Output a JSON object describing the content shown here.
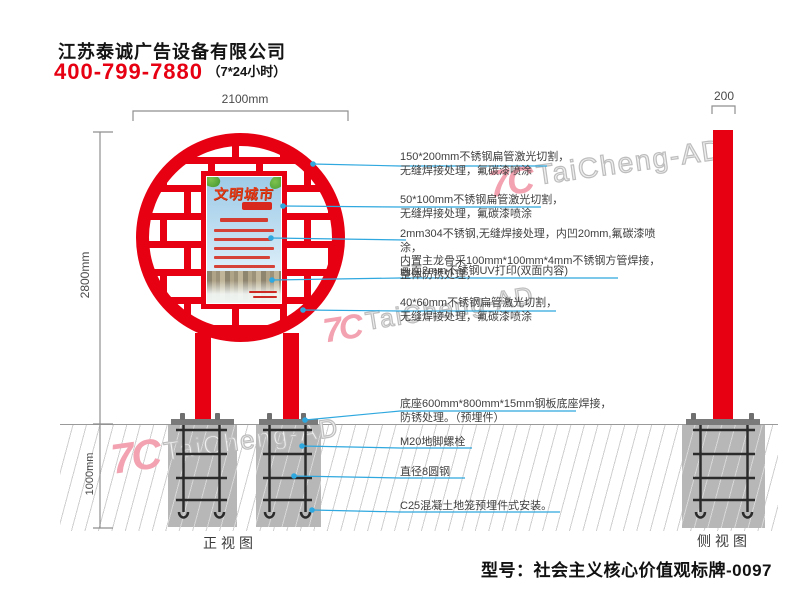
{
  "header": {
    "company": "江苏泰诚广告设备有限公司",
    "phone": "400-799-7880",
    "hours": "（7*24小时）"
  },
  "dimensions": {
    "top_width": "2100mm",
    "height_above_ground": "2800mm",
    "depth_below_ground": "1000mm",
    "side_width": "200"
  },
  "views": {
    "front": "正视图",
    "side": "侧视图"
  },
  "poster": {
    "title": "文明城市"
  },
  "annotations": [
    {
      "lines": [
        "150*200mm不锈钢扁管激光切割，",
        "无缝焊接处理，氟碳漆喷涂"
      ]
    },
    {
      "lines": [
        "50*100mm不锈钢扁管激光切割，",
        "无缝焊接处理，氟碳漆喷涂"
      ]
    },
    {
      "lines": [
        "2mm304不锈钢,无缝焊接处理，内凹20mm,氟碳漆喷涂，",
        "内置主龙骨采100mm*100mm*4mm不锈钢方管焊接，",
        "整体防锈处理，"
      ]
    },
    {
      "lines": [
        "画面2mm不锈钢UV打印(双面内容)"
      ]
    },
    {
      "lines": [
        "40*60mm不锈钢扁管激光切割，",
        "无缝焊接处理，氟碳漆喷涂"
      ]
    },
    {
      "lines": [
        "底座600mm*800mm*15mm钢板底座焊接，",
        "防锈处理。（预埋件）"
      ]
    },
    {
      "lines": [
        "M20地脚螺栓"
      ]
    },
    {
      "lines": [
        "直径8圆钢"
      ]
    },
    {
      "lines": [
        "C25混凝土地笼预埋件式安装。"
      ]
    }
  ],
  "watermark": {
    "text": "TaiCheng-AD",
    "logo_glyph": "7C"
  },
  "footer": {
    "model": "型号：社会主义核心价值观标牌-0097"
  },
  "colors": {
    "brand_red": "#e60012",
    "leader_blue": "#2fa8df",
    "watermark_pink": "#f2a2b0",
    "watermark_gray": "#bdbdbd",
    "concrete_gray": "#b7b7b7"
  }
}
